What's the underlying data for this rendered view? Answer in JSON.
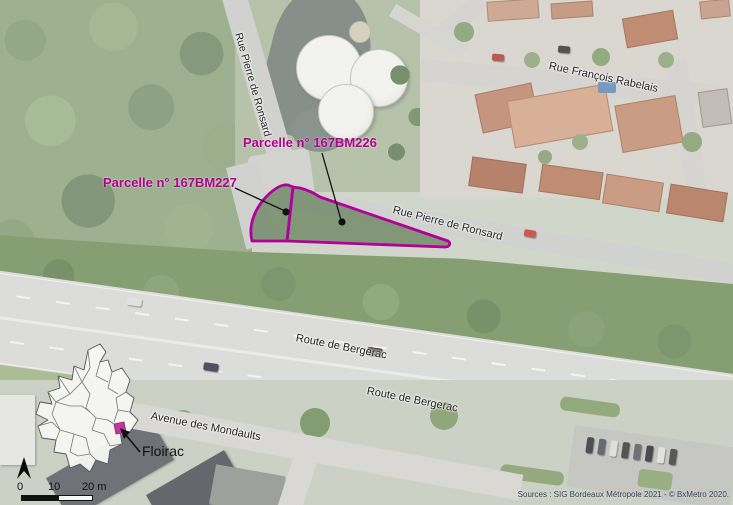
{
  "parcels": {
    "outline_color": "#b2009b",
    "label_color": "#b2008f",
    "p226": {
      "label": "Parcelle n° 167BM226"
    },
    "p227": {
      "label": "Parcelle n° 167BM227"
    }
  },
  "streets": {
    "rue_pierre_de_ronsard_top": "Rue Pierre de Ronsard",
    "rue_francois_rabelais": "Rue François Rabelais",
    "rue_pierre_de_ronsard_mid": "Rue Pierre de Ronsard",
    "route_de_bergerac_upper": "Route de Bergerac",
    "route_de_bergerac_lower": "Route de Bergerac",
    "avenue_des_mondaults": "Avenue des Mondaults"
  },
  "inset": {
    "commune_label": "Floirac",
    "highlight_color": "#c5359f"
  },
  "scale_bar": {
    "tick_0": "0",
    "tick_10": "10",
    "tick_20": "20 m"
  },
  "attribution": "Sources : SIG Bordeaux Métropole 2021 - © BxMetro 2020."
}
